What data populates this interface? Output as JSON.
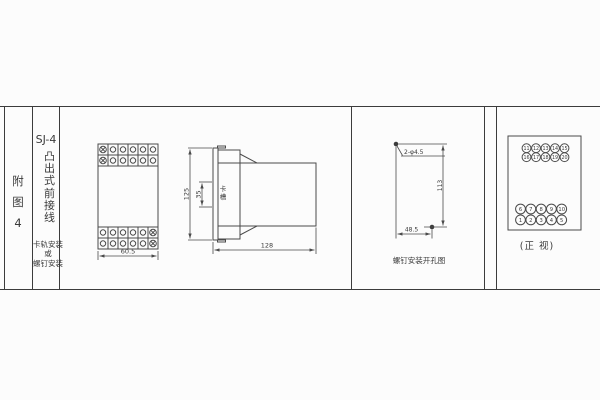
{
  "colors": {
    "background": "#fcfcfc",
    "line": "#4a4a4a",
    "grid_line": "#3c3c3c",
    "text": "#3a3a3a"
  },
  "sidebar": {
    "figure_label": "附图4",
    "model_title": "SJ-4",
    "model_subtitle_vertical": "凸出式前接线",
    "mounting_note_line1": "卡轨安装",
    "mounting_note_line2": "或",
    "mounting_note_line3": "螺钉安装"
  },
  "front_view": {
    "width_dim": "60.5"
  },
  "side_view": {
    "height_dim": "125",
    "slot_dim": "35",
    "slot_label": "卡槽",
    "depth_dim": "128"
  },
  "drill_view": {
    "hole_label": "2-φ4.5",
    "vertical_dim": "113",
    "horizontal_dim": "48.5",
    "caption": "螺钉安装开孔图"
  },
  "terminal_view": {
    "caption": "(正 视)",
    "top_rows": [
      [
        "11",
        "12",
        "13",
        "14",
        "15"
      ],
      [
        "16",
        "17",
        "18",
        "19",
        "20"
      ]
    ],
    "bottom_rows": [
      [
        "6",
        "7",
        "8",
        "9",
        "10"
      ],
      [
        "1",
        "2",
        "3",
        "4",
        "5"
      ]
    ]
  }
}
